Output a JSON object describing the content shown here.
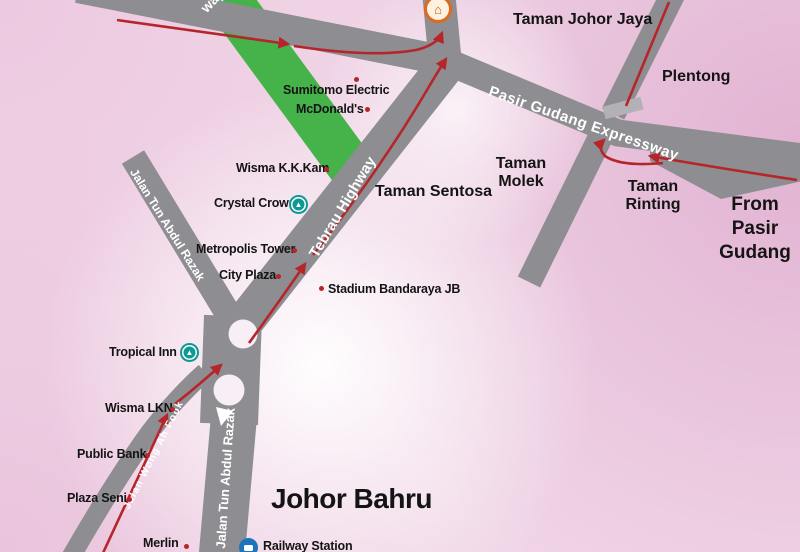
{
  "map": {
    "roads": {
      "green_partial": "way",
      "tebrau": "Tebrau Highway",
      "pasir_gudang_expressway": "Pasir Gudang Expressway",
      "jalan_tun_abdul_razak_upper": "Jalan Tun Abdul Razak",
      "jalan_tun_abdul_razak_lower": "Jalan Tun Abdul Razak",
      "jalan_wong_ah_fook": "Jalan Wong Ah Fook"
    },
    "areas": {
      "taman_johor_jaya": "Taman Johor Jaya",
      "plentong": "Plentong",
      "taman_sentosa": "Taman Sentosa",
      "taman_molek": "Taman Molek",
      "taman_rinting": "Taman Rinting",
      "from_pasir_gudang": "From Pasir Gudang",
      "johor_bahru": "Johor Bahru"
    },
    "landmarks": {
      "sumitomo_electric": "Sumitomo Electric",
      "mcdonalds": "McDonald's",
      "wisma_kk_kam": "Wisma K.K.Kam",
      "crystal_crown": "Crystal Crown",
      "metropolis_tower": "Metropolis Tower",
      "city_plaza": "City Plaza",
      "stadium_bandaraya_jb": "Stadium Bandaraya JB",
      "tropical_inn": "Tropical Inn",
      "wisma_lkn": "Wisma LKN",
      "public_bank": "Public Bank",
      "plaza_seni": "Plaza Seni",
      "merlin": "Merlin",
      "railway_station": "Railway Station"
    },
    "icons": {
      "destination": "destination-marker",
      "hotel": "hotel-marker",
      "railway": "railway-marker"
    },
    "colors": {
      "background_pink": "#f0d5e6",
      "road_gray": "#8e8d91",
      "ramp_gray": "#b3b1b5",
      "green_road": "#45b24a",
      "route_red": "#b5262b",
      "hotel_icon_teal": "#0d9a92",
      "railway_icon_blue": "#1c75bb",
      "destination_icon_orange": "#dd6a1e",
      "label_black": "#141414"
    }
  }
}
